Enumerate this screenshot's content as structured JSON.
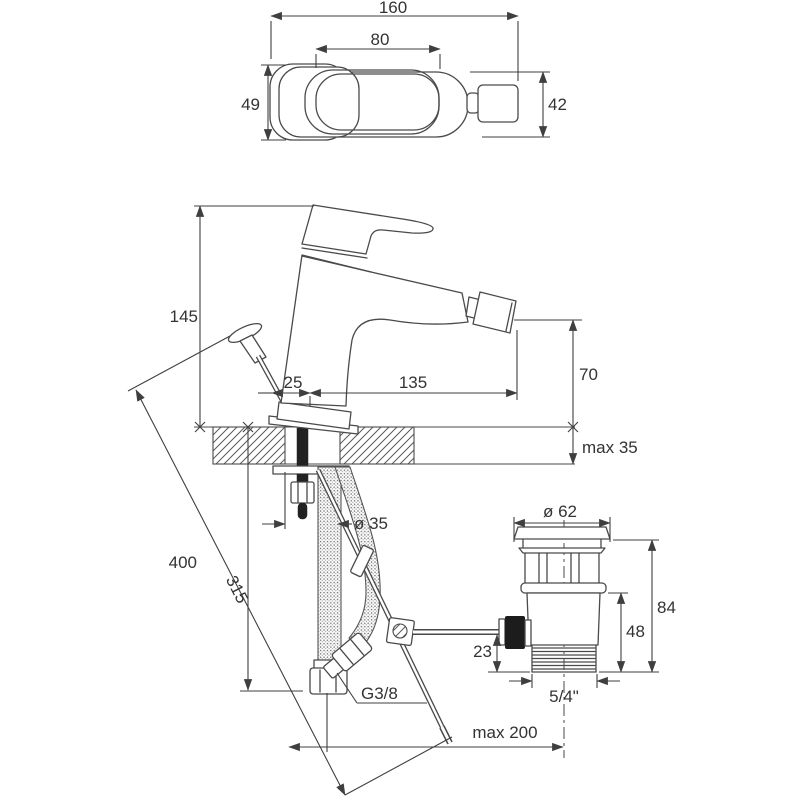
{
  "drawing": {
    "type": "technical-dimension-drawing",
    "subject": "bidet single-lever mixer faucet with pop-up waste, installation dimensions",
    "background_color": "#ffffff",
    "line_color": "#4a4a4a",
    "text_color": "#333333",
    "views": {
      "top_view": {
        "total_width": "160",
        "handle_width": "80",
        "body_depth_left": "49",
        "body_depth_right": "42"
      },
      "side_view": {
        "body_height": "145",
        "rod_offset": "25",
        "spout_reach": "135",
        "spout_height": "70",
        "deck_thickness": "max 35",
        "hole_diameter": "ø 35"
      },
      "below_deck": {
        "hose_length": "400",
        "pull_rod_length": "315",
        "hose_thread": "G3/8",
        "rod_reach": "max 200"
      },
      "drain": {
        "flange_diameter": "ø 62",
        "total_height": "84",
        "body_height": "48",
        "rod_height": "23",
        "thread": "5/4\""
      }
    }
  }
}
